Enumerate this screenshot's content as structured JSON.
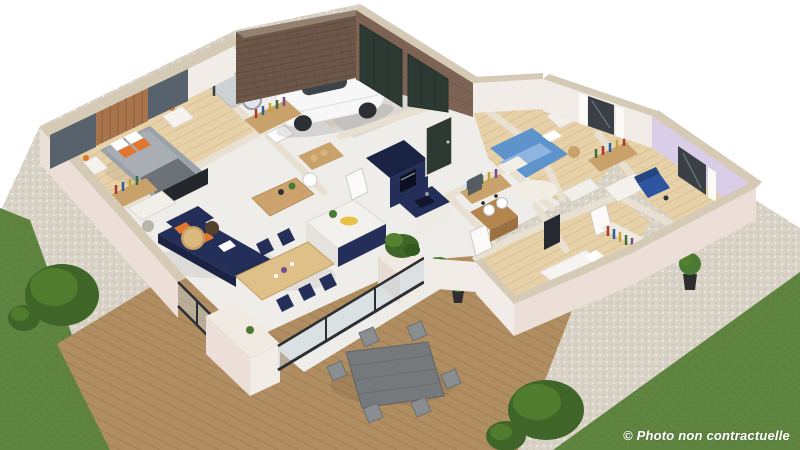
{
  "meta": {
    "type": "3d-floorplan-render",
    "description": "Isometric 3D cutaway rendering of a single-storey house with garage, furnished rooms, wooden terrace and garden"
  },
  "watermark": {
    "text": "© Photo non contractuelle",
    "color": "#ffffff"
  },
  "palette": {
    "white": "#ffffff",
    "wallFace": "#f1ece7",
    "wallPink": "#ebdfd8",
    "wallCap": "#d5cab6",
    "tealWall": "#57626c",
    "woodSlatWall": "#a8744c",
    "woodSlatDark": "#8a5c39",
    "brick": "#6d5749",
    "brickCap": "#93806f",
    "woodWallGarage": "#7c6353",
    "doorGreen": "#2d3a33",
    "doorGreenDark": "#24302a",
    "navy": "#232f58",
    "navyDark": "#1a2344",
    "orange": "#e2762f",
    "oakFloor": "#e6d1a9",
    "oakLine": "#caa878",
    "tileFloor": "#efedea",
    "concrete": "#dbd8d4",
    "carWhite": "#f7f7f7",
    "carGlass": "#3c434a",
    "wheelDark": "#2c2f33",
    "glassTint": "#c3d2dc",
    "frameDark": "#2b2e33",
    "bedBlue": "#5f93cc",
    "bedGray": "#9aa1a8",
    "throwGray": "#6d7277",
    "lavender": "#d9cde8",
    "pinkThrow": "#c08b8c",
    "vanityWood": "#b5854e",
    "tableWood": "#dfc089",
    "sideboardWood": "#cda26e",
    "chairTan": "#c9a26b",
    "outdoorTable": "#75797c",
    "outdoorChair": "#8a8e91",
    "deckWood": "#b18e62",
    "deckLine": "#8f7049",
    "gravel": "#d9d3c7",
    "gravelDot": "#c5beae",
    "lawn": "#5f8440",
    "lawnDark": "#4e7334",
    "bush": "#3f6628",
    "bushLight": "#558230",
    "plantGreen": "#4a7a33",
    "plantDark": "#33591f",
    "windowDark": "#3a4046",
    "curtain": "#fbfaf7",
    "bookRed": "#a63b2e",
    "bookBlue": "#2f5f9e",
    "bookYellow": "#c7a23a",
    "bookGreen": "#3f6d3a",
    "bookPurple": "#7a4a8e",
    "wallStroke": "#e8e0d0"
  },
  "rooms": [
    {
      "id": "master-bedroom",
      "label": "Master bedroom",
      "furniture": [
        "double-bed",
        "orange-cushions",
        "gray-throw",
        "nightstands",
        "wall-lamps",
        "wood-slat-accent-wall",
        "teal-accent-wall",
        "bookshelf-desk",
        "wall-tv"
      ]
    },
    {
      "id": "bathroom-shower",
      "label": "Shower room",
      "furniture": [
        "walk-in-shower",
        "round-mirror",
        "washbasin"
      ]
    },
    {
      "id": "garage",
      "label": "Garage",
      "furniture": [
        "white-car",
        "brick-wall",
        "green-garage-doors",
        "concrete-floor"
      ]
    },
    {
      "id": "kitchen",
      "label": "Kitchen",
      "furniture": [
        "navy-tall-cabinet",
        "oven",
        "navy-island",
        "lemon-tray",
        "sink-counter"
      ]
    },
    {
      "id": "living-dining",
      "label": "Living / dining room",
      "furniture": [
        "navy-corner-sofa",
        "orange-cushions",
        "round-coffee-tables",
        "tv-sideboard",
        "desk-and-chair",
        "dining-table",
        "six-navy-chairs",
        "glass-sliding-walls"
      ]
    },
    {
      "id": "bedroom-2",
      "label": "Bedroom 2",
      "furniture": [
        "blue-double-bed",
        "desk",
        "chair",
        "round-rug",
        "window-curtains",
        "wall-art"
      ]
    },
    {
      "id": "bedroom-3",
      "label": "Bedroom 3",
      "furniture": [
        "lavender-wall",
        "blue-armchair",
        "white-dresser",
        "window-curtains"
      ]
    },
    {
      "id": "bathroom-2",
      "label": "Bathroom",
      "furniture": [
        "wood-double-vanity",
        "round-basins",
        "black-faucets",
        "mirror"
      ]
    },
    {
      "id": "bedroom-4",
      "label": "Bedroom 4",
      "furniture": [
        "white-bed-pink-throw",
        "wardrobe-with-clothes",
        "wall-tv"
      ]
    },
    {
      "id": "hallway",
      "label": "Hallway",
      "furniture": [
        "bookshelves",
        "storage-closet",
        "laundry-basket",
        "green-front-door"
      ]
    }
  ],
  "exterior": {
    "features": [
      "wood-deck",
      "outdoor-dining-table",
      "six-outdoor-chairs",
      "left-lawn",
      "right-lawn",
      "shrubs",
      "gravel-border",
      "terrace-planter",
      "potted-plants",
      "tile-apron"
    ]
  }
}
